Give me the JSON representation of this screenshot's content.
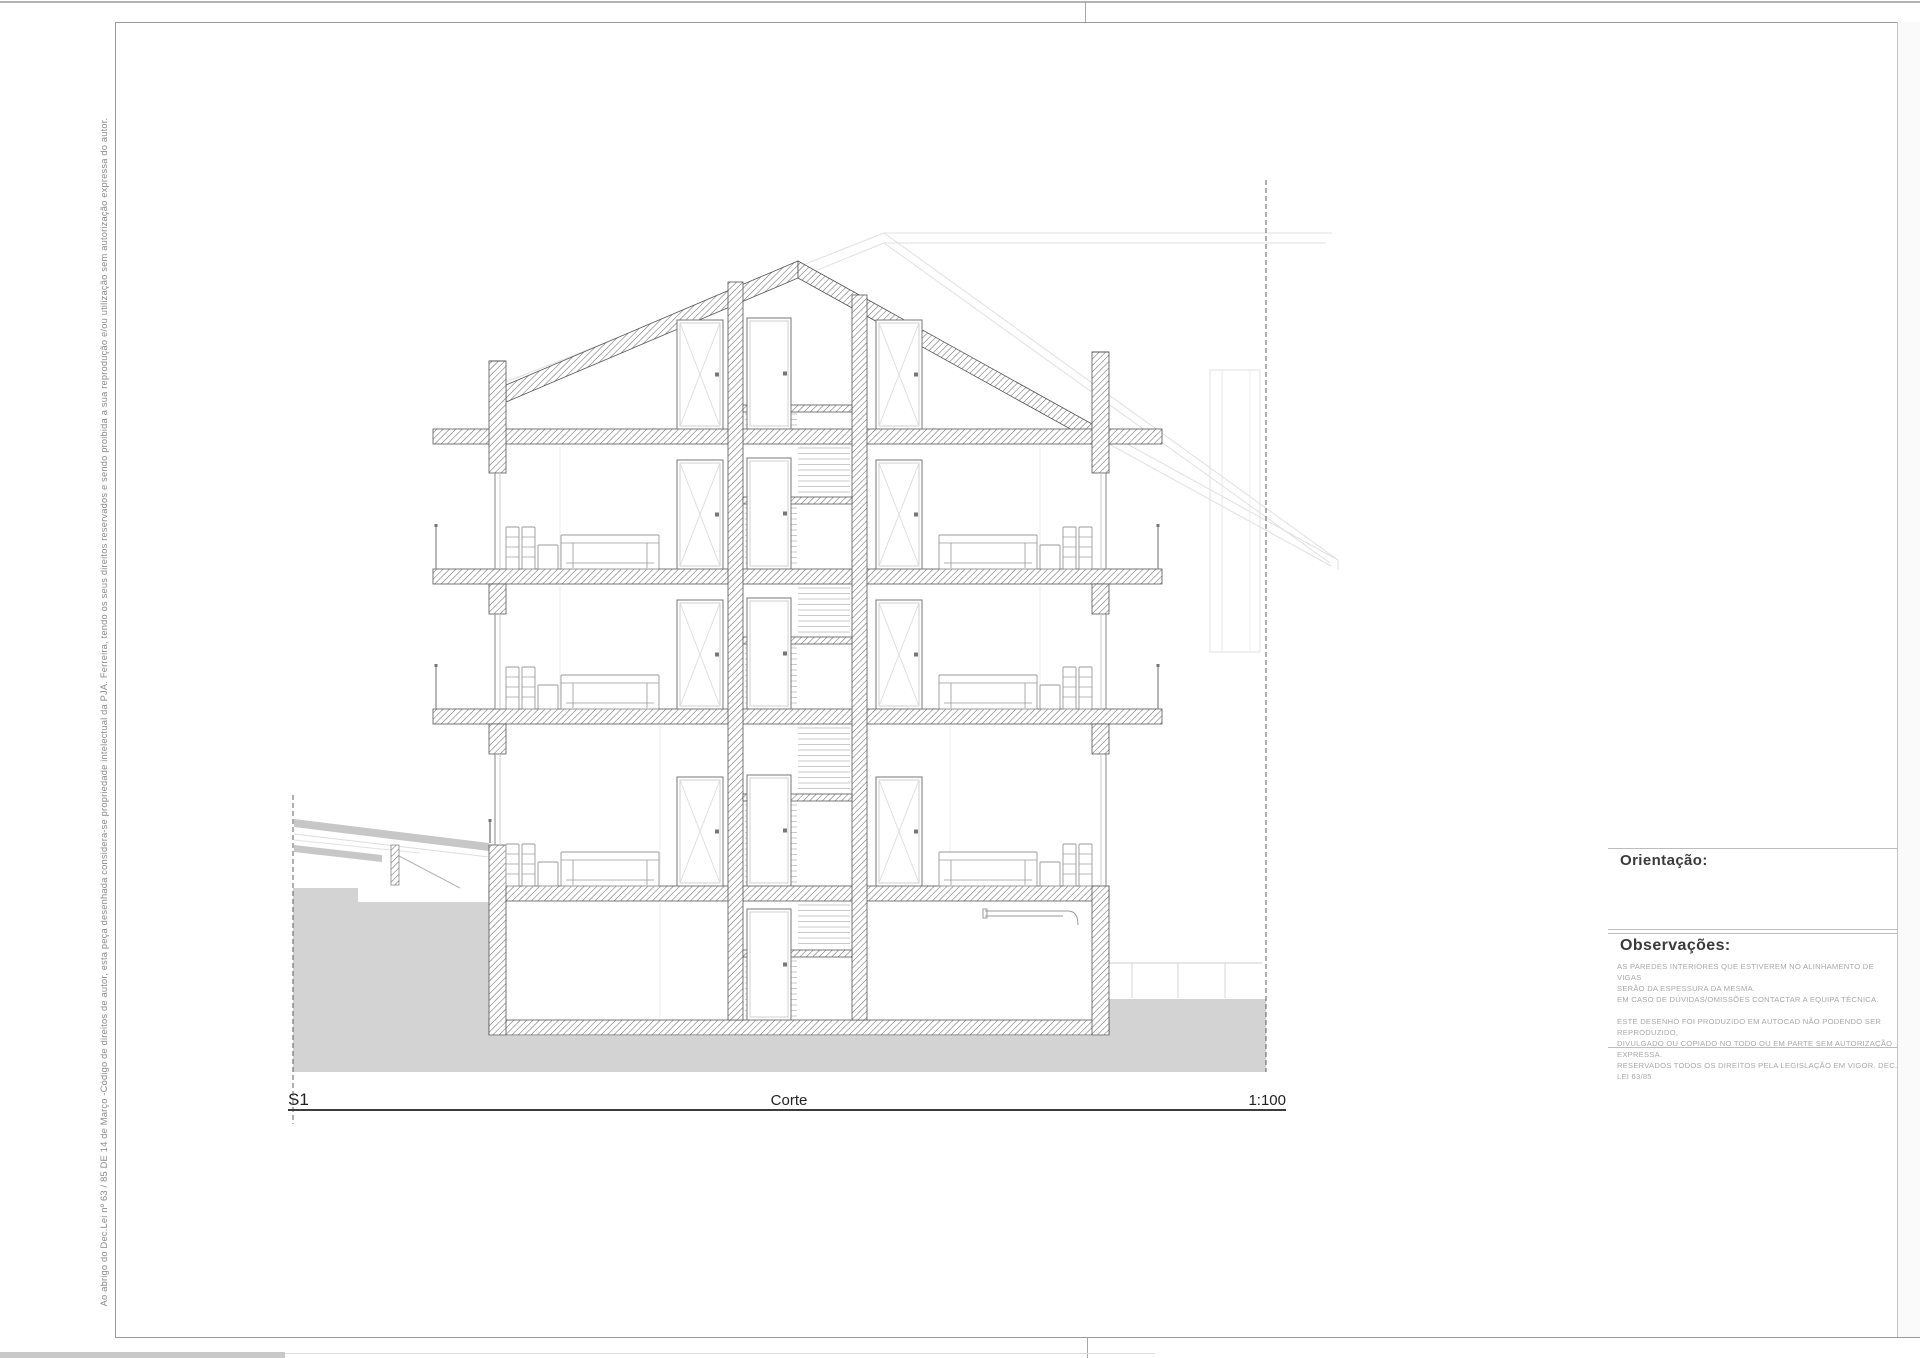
{
  "sheet": {
    "copyright_vertical_text": "Ao abrigo do Dec.Lei nº 63 / 85 DE 14 de Março -Código de direitos de autor, esta peça desenhada considera-se propriedade intelectual da PJA. Ferreira, tendo os seus direitos reservados e sendo proibida a sua reprodução e/ou utilização sem autorização expressa do autor."
  },
  "drawing": {
    "label": "S1",
    "title": "Corte",
    "scale": "1:100",
    "earth_color": "#d3d3d3",
    "hatch_color": "#6e6e6e"
  },
  "title_block": {
    "orientation_label": "Orientação:",
    "observations_label": "Observações:",
    "notes": [
      "AS PAREDES INTERIORES QUE ESTIVEREM NO ALINHAMENTO DE VIGAS\nSERÃO DA ESPESSURA DA MESMA.",
      "EM CASO DE DÚVIDAS/OMISSÕES CONTACTAR A EQUIPA TÉCNICA.",
      "ESTE DESENHO FOI PRODUZIDO EM AUTOCAD NÃO PODENDO SER REPRODUZIDO,\nDIVULGADO OU COPIADO NO TODO OU EM PARTE SEM AUTORIZAÇÃO EXPRESSA.\nRESERVADOS TODOS OS DIREITOS PELA LEGISLAÇÃO EM VIGOR. DEC. LEI 63/85"
    ]
  }
}
